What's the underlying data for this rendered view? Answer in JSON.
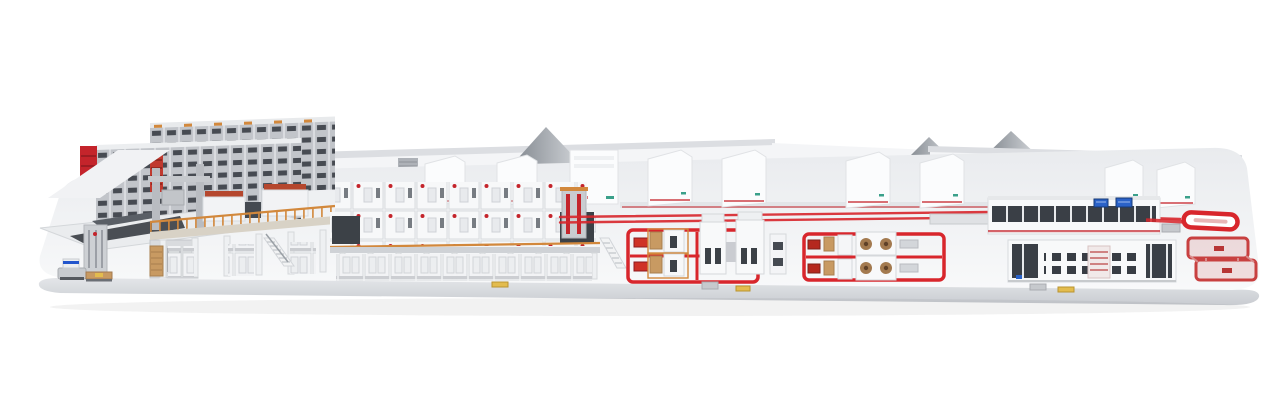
{
  "scene": {
    "name": "corrugated-board-production-line-3d-render",
    "background": "#ffffff",
    "palette": {
      "background": "#ffffff",
      "platform_top_back": "#e9ebee",
      "platform_top_front": "#f7f8fa",
      "platform_face": "#e0e2e5",
      "platform_face_dark": "#c9ccd1",
      "building_white": "#f4f5f7",
      "building_shade": "#dcdee2",
      "roof_gray_dark": "#81878e",
      "roof_gray_light": "#d3d6da",
      "machine_white": "#f8f9fa",
      "machine_edge": "#d7dade",
      "dark_panel": "#3c4147",
      "steel_gray": "#b9bcc1",
      "rack_gray": "#c2c5ca",
      "rack_slot": "#474b52",
      "accent_red": "#c4242b",
      "safety_red": "#d8262c",
      "bright_red": "#cf3227",
      "orange_structure": "#d2883c",
      "wood_tan": "#c89a62",
      "roll_brown": "#a37a4f",
      "roll_core": "#5f4128",
      "screen_blue": "#2a62c8",
      "agv_blue": "#2255cc",
      "pallet_yellow": "#e3bc4e",
      "teal_logo": "#3aa08a"
    },
    "elements": [
      {
        "name": "background-buildings"
      },
      {
        "name": "display-platform"
      },
      {
        "name": "roll-storage-rack"
      },
      {
        "name": "splice-table"
      },
      {
        "name": "gantry-feeder"
      },
      {
        "name": "splicer-tower"
      },
      {
        "name": "agv-shuttle"
      },
      {
        "name": "transport-pallet"
      },
      {
        "name": "wet-end-mezzanine"
      },
      {
        "name": "dry-end-line"
      },
      {
        "name": "machine-hood-row"
      },
      {
        "name": "floor-conveyor-lines"
      },
      {
        "name": "converting-cell-a"
      },
      {
        "name": "converting-cell-b"
      },
      {
        "name": "logistics-glass-line"
      },
      {
        "name": "control-screens"
      },
      {
        "name": "palletizer-line"
      },
      {
        "name": "racetrack-conveyor"
      },
      {
        "name": "loop-conveyor"
      }
    ]
  }
}
